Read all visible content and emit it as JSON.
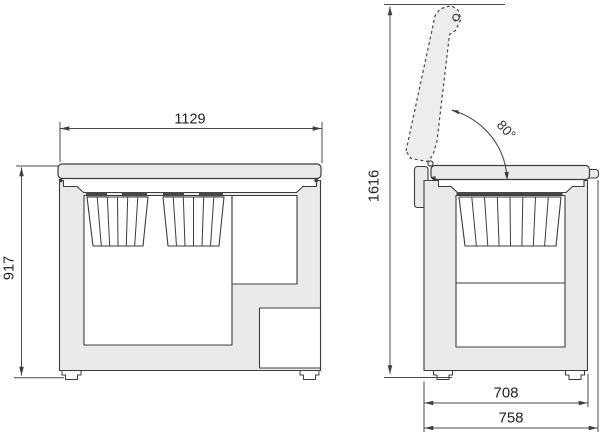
{
  "title": "Chest freezer dimension drawing",
  "views": {
    "front": {
      "name": "front-elevation",
      "dim_width": "1129",
      "dim_height": "917"
    },
    "side": {
      "name": "side-elevation",
      "dim_height_lid_open": "1616",
      "lid_angle": "80°",
      "dim_depth_body": "708",
      "dim_depth_overall": "758"
    }
  },
  "style": {
    "body_fill": "#e9eaea",
    "lid_open_fill": "#ecedee",
    "line_color": "#3c3c3c",
    "dim_color": "#4a4a4a",
    "rim_color": "#474747",
    "text_color": "#222222"
  }
}
